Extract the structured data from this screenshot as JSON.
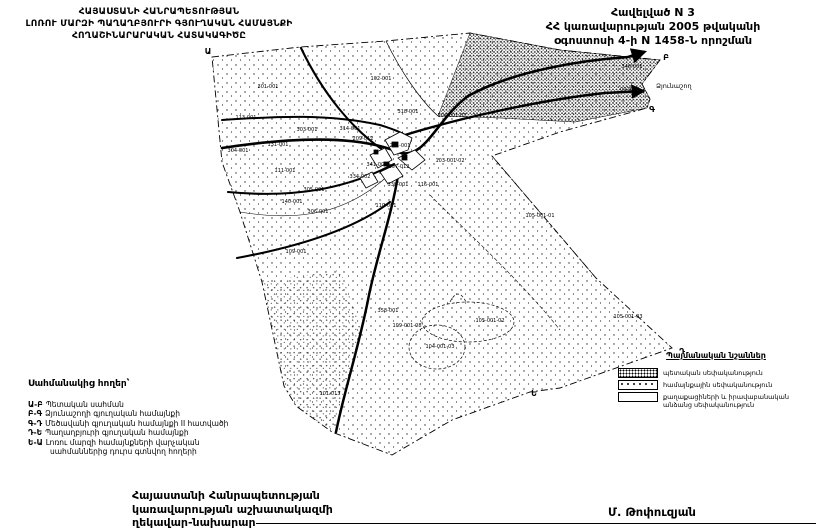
{
  "header": {
    "left_title_lines": [
      "ՀԱՅԱՍՏԱՆԻ ՀԱՆՐԱՊԵՏՈՒԹՅԱՆ",
      "ԼՈՌՈՒ ՄԱՐԶԻ ՊԱՂԱՂԲՅՈՒՐԻ ԳՅՈՒՂԱԿԱՆ ՀԱՄԱՅՆՔԻ",
      "ՀՈՂԱՇԻՆԱՐԱՐԱԿԱՆ ՀԱՏԱԿԱԳԻԾԸ"
    ],
    "right_title_lines": [
      "Հավելված N 3",
      "ՀՀ կառավարության 2005 թվականի",
      "օգոստոսի 4-ի N 1458-Ն որոշման"
    ]
  },
  "map": {
    "neighbor_label": "Ձյունաշող",
    "ink_color": "#000000",
    "corner_points": [
      {
        "label": "Ա",
        "x": 208,
        "y": 54
      },
      {
        "label": "Բ",
        "x": 666,
        "y": 60
      },
      {
        "label": "Գ",
        "x": 652,
        "y": 112
      },
      {
        "label": "Դ",
        "x": 682,
        "y": 354
      },
      {
        "label": "Ե",
        "x": 534,
        "y": 396
      }
    ],
    "parcel_labels": [
      {
        "id": "301-001",
        "x": 268,
        "y": 88
      },
      {
        "id": "102-001",
        "x": 381,
        "y": 80
      },
      {
        "id": "113-001",
        "x": 246,
        "y": 119
      },
      {
        "id": "303-001",
        "x": 307,
        "y": 131
      },
      {
        "id": "131-001",
        "x": 278,
        "y": 146
      },
      {
        "id": "304-001",
        "x": 238,
        "y": 152
      },
      {
        "id": "314-001",
        "x": 350,
        "y": 130
      },
      {
        "id": "318-001",
        "x": 408,
        "y": 113
      },
      {
        "id": "104-001-01",
        "x": 452,
        "y": 117
      },
      {
        "id": "209-012",
        "x": 363,
        "y": 140
      },
      {
        "id": "201-001",
        "x": 400,
        "y": 147
      },
      {
        "id": "341-001",
        "x": 377,
        "y": 166
      },
      {
        "id": "657-012",
        "x": 399,
        "y": 168
      },
      {
        "id": "103-001-02",
        "x": 450,
        "y": 162
      },
      {
        "id": "334-002",
        "x": 360,
        "y": 178
      },
      {
        "id": "338-001",
        "x": 398,
        "y": 186
      },
      {
        "id": "116-001",
        "x": 428,
        "y": 186
      },
      {
        "id": "110-001",
        "x": 386,
        "y": 207
      },
      {
        "id": "111-001",
        "x": 285,
        "y": 172
      },
      {
        "id": "305-001",
        "x": 314,
        "y": 191
      },
      {
        "id": "140-001",
        "x": 292,
        "y": 203
      },
      {
        "id": "306-001",
        "x": 318,
        "y": 213
      },
      {
        "id": "109-001",
        "x": 296,
        "y": 253
      },
      {
        "id": "346-001",
        "x": 632,
        "y": 68
      },
      {
        "id": "09-001",
        "x": 629,
        "y": 91
      },
      {
        "id": "105-001-01",
        "x": 540,
        "y": 217
      },
      {
        "id": "358-001",
        "x": 388,
        "y": 312
      },
      {
        "id": "109-001-08",
        "x": 407,
        "y": 327
      },
      {
        "id": "105-001-02",
        "x": 490,
        "y": 322
      },
      {
        "id": "104-001-03",
        "x": 440,
        "y": 348
      },
      {
        "id": "105-001-03",
        "x": 628,
        "y": 318
      },
      {
        "id": "101-013",
        "x": 330,
        "y": 395
      }
    ]
  },
  "left_legend": {
    "title": "Սահմանակից հողեր՝",
    "items": [
      {
        "code": "Ա-Բ",
        "text": "Պետական սահման"
      },
      {
        "code": "Բ-Գ",
        "text": "Ձյունաշողի գյուղական համայնքի"
      },
      {
        "code": "Գ-Դ",
        "text": "Մեծավանի գյուղական համայնքի II հատվածի"
      },
      {
        "code": "Դ-Ե",
        "text": "Պաղաղբյուրի գյուղական համայնքի"
      },
      {
        "code": "Ե-Ա",
        "text": "Լոռու մարզի համայնքների վարչական",
        "text2": "սահմաններից դուրս գտնվող հողերի"
      }
    ]
  },
  "right_legend": {
    "title": "Պայմանական նշաններ",
    "items": [
      {
        "label": "պետական սեփականություն",
        "label2": ""
      },
      {
        "label": "համայնքային սեփականություն",
        "label2": ""
      },
      {
        "label": "քաղաքացիների և իրավաբանական",
        "label2": "անձանց սեփականություն"
      }
    ]
  },
  "footer": {
    "left_lines": [
      "Հայաստանի Հանրապետության",
      "կառավարության աշխատակազմի",
      "ղեկավար-նախարար"
    ],
    "signature": "Մ. Թոփուզյան"
  }
}
